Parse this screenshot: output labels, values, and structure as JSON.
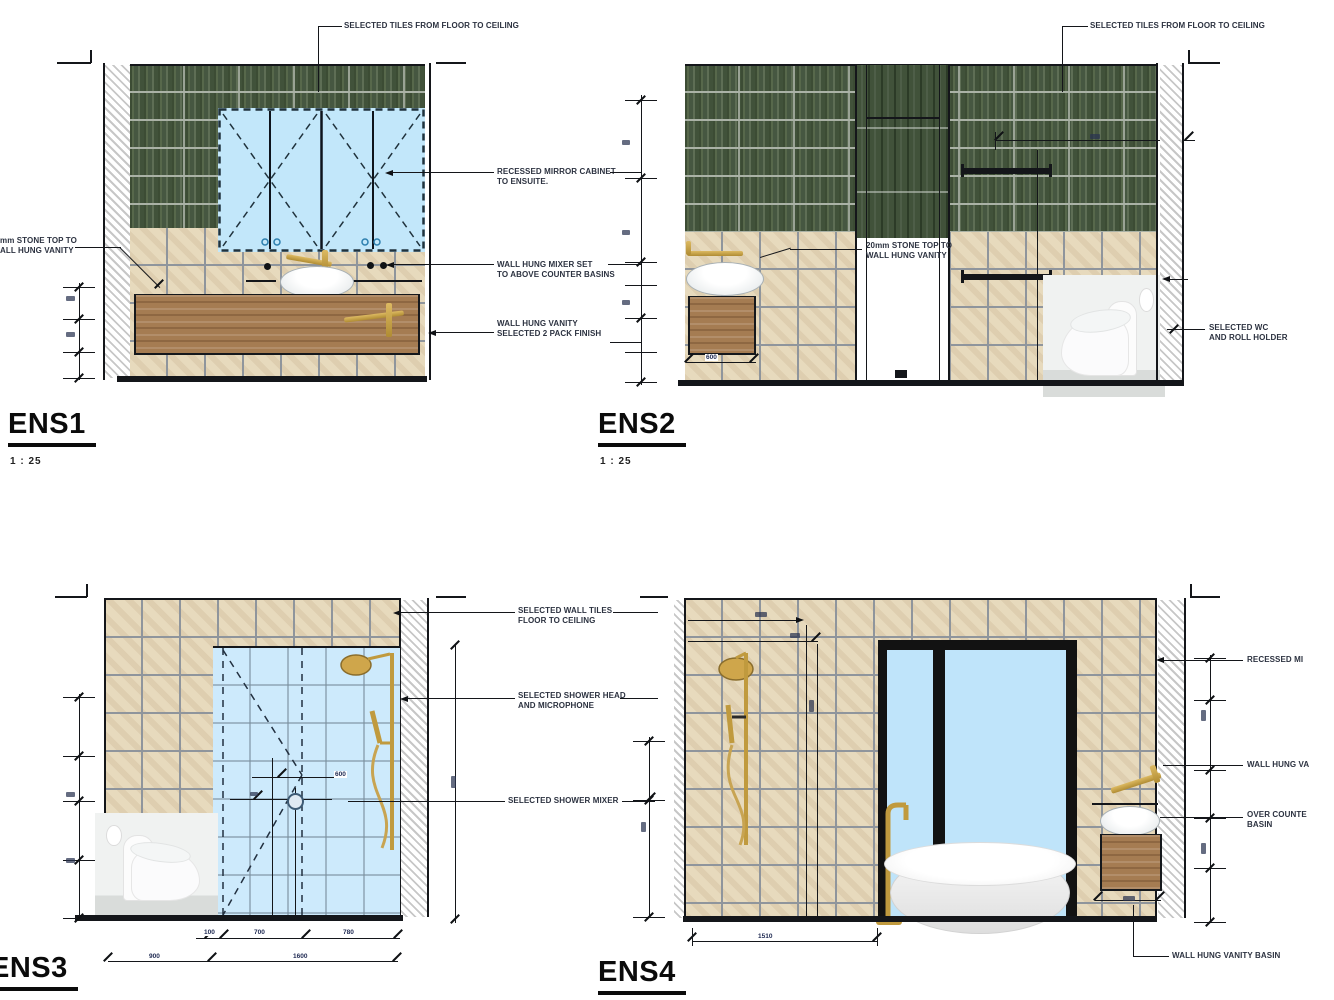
{
  "sheet": {
    "background": "#ffffff"
  },
  "palette": {
    "green_tile": "#4a5a41",
    "beige_tile": "#e7dabd",
    "glass": "#c9e9fb",
    "wood": "#a57c52",
    "gold": "#c9a144",
    "line": "#14161a",
    "annotation_text": "#2c3240"
  },
  "elevations": {
    "ens1": {
      "title": "ENS1",
      "scale": "1 : 25",
      "annotations": {
        "tiles": "SELECTED TILES FROM FLOOR TO CEILING",
        "stone_top": "mm STONE TOP TO\nALL HUNG VANITY",
        "mirror_cabinet": "RECESSED MIRROR CABINET\nTO ENSUITE.",
        "mixer": "WALL HUNG MIXER SET\nTO ABOVE COUNTER BASINS",
        "vanity": "WALL HUNG VANITY\nSELECTED 2 PACK FINISH"
      }
    },
    "ens2": {
      "title": "ENS2",
      "scale": "1 : 25",
      "annotations": {
        "tiles": "SELECTED TILES FROM FLOOR TO CEILING",
        "stone_top": "20mm STONE TOP TO\nWALL HUNG VANITY",
        "wc": "SELECTED WC\nAND ROLL HOLDER"
      },
      "dims": {
        "vanity_width": "600"
      }
    },
    "ens3": {
      "title": "ENS3",
      "annotations": {
        "wall_tiles": "SELECTED WALL TILES\nFLOOR TO CEILING",
        "shower_head": "SELECTED SHOWER HEAD\nAND MICROPHONE",
        "shower_mixer": "SELECTED SHOWER MIXER"
      },
      "dims": {
        "seg_small": "100",
        "seg_mid": "700",
        "seg_right": "780",
        "left_total": "900",
        "right_total": "1600",
        "mixer_offset": "600"
      }
    },
    "ens4": {
      "title": "ENS4",
      "annotations": {
        "recessed_mirror": "RECESSED MI",
        "wall_hung": "WALL HUNG VA",
        "over_counter": "OVER COUNTE\nBASIN",
        "vanity_basin": "WALL HUNG VANITY BASIN"
      },
      "dims": {
        "bath_offset": "1510"
      }
    }
  }
}
